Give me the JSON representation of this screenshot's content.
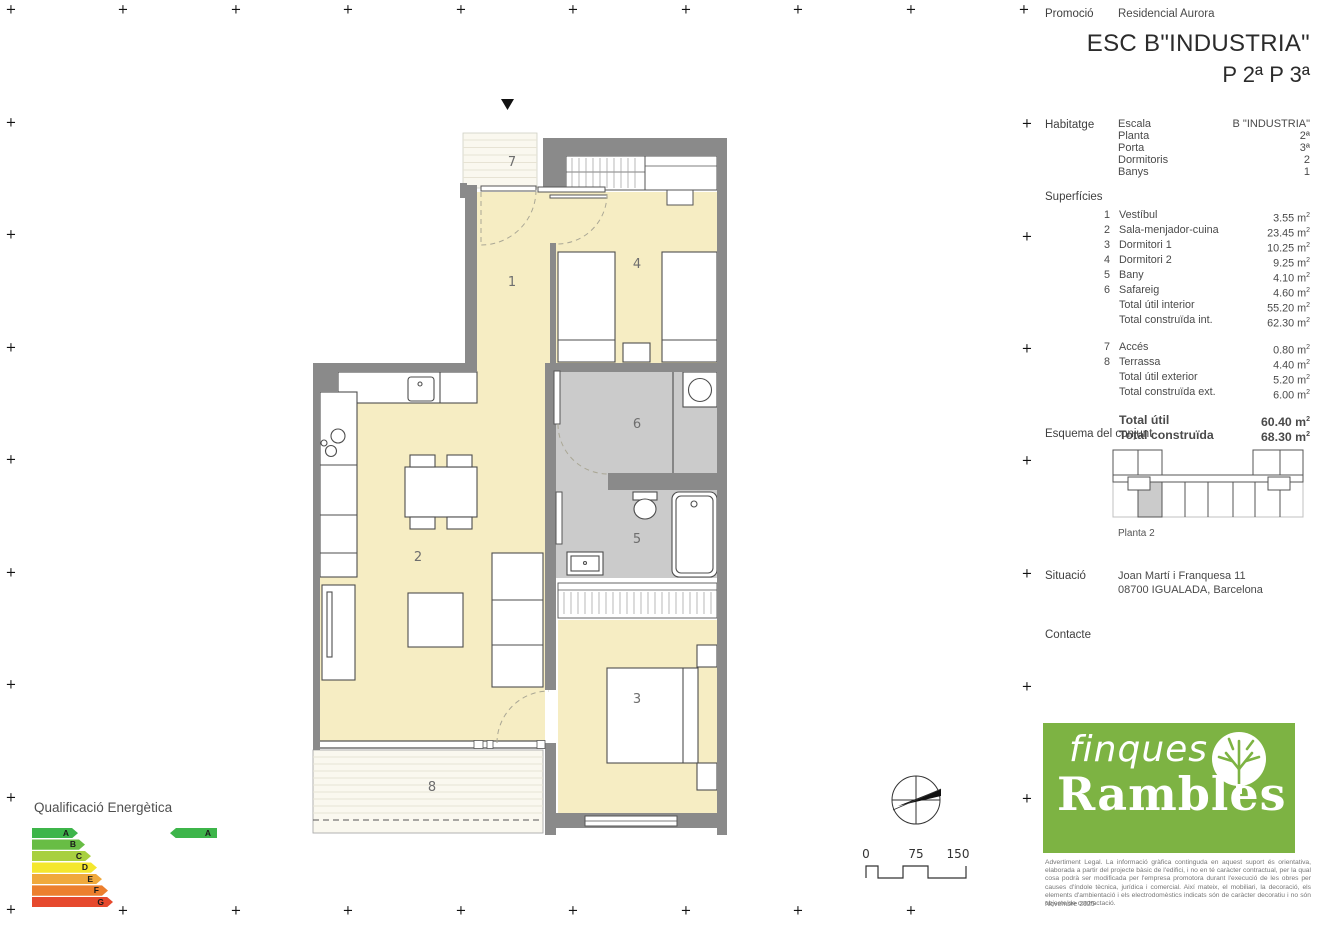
{
  "header": {
    "promo_label": "Promoció",
    "promo_value": "Residencial Aurora",
    "title": "ESC B\"INDUSTRIA\"",
    "subtitle": "P 2ª P 3ª"
  },
  "habitatge": {
    "label": "Habitatge",
    "rows": [
      {
        "k": "Escala",
        "v": "B \"INDUSTRIA\""
      },
      {
        "k": "Planta",
        "v": "2ª"
      },
      {
        "k": "Porta",
        "v": "3ª"
      },
      {
        "k": "Dormitoris",
        "v": "2"
      },
      {
        "k": "Banys",
        "v": "1"
      }
    ]
  },
  "surfaces": {
    "label": "Superfícies",
    "unit_base": "m",
    "unit_sup": "2",
    "group1": [
      {
        "num": "1",
        "name": "Vestíbul",
        "area": "3.55"
      },
      {
        "num": "2",
        "name": "Sala-menjador-cuina",
        "area": "23.45"
      },
      {
        "num": "3",
        "name": "Dormitori 1",
        "area": "10.25"
      },
      {
        "num": "4",
        "name": "Dormitori 2",
        "area": "9.25"
      },
      {
        "num": "5",
        "name": "Bany",
        "area": "4.10"
      },
      {
        "num": "6",
        "name": "Safareig",
        "area": "4.60"
      },
      {
        "num": "",
        "name": "Total útil interior",
        "area": "55.20"
      },
      {
        "num": "",
        "name": "Total construïda int.",
        "area": "62.30"
      }
    ],
    "group2": [
      {
        "num": "7",
        "name": "Accés",
        "area": "0.80"
      },
      {
        "num": "8",
        "name": "Terrassa",
        "area": "4.40"
      },
      {
        "num": "",
        "name": "Total útil exterior",
        "area": "5.20"
      },
      {
        "num": "",
        "name": "Total construïda ext.",
        "area": "6.00"
      }
    ],
    "totals": [
      {
        "num": "",
        "name": "Total útil",
        "area": "60.40"
      },
      {
        "num": "",
        "name": "Total construïda",
        "area": "68.30"
      }
    ]
  },
  "esquema": {
    "label": "Esquema del conjunt",
    "caption": "Planta 2"
  },
  "situacio": {
    "label": "Situació",
    "line1": "Joan Martí i Franquesa 11",
    "line2": "08700 IGUALADA, Barcelona"
  },
  "contacte": {
    "label": "Contacte"
  },
  "logo": {
    "line1": "finques",
    "line2": "Rambles"
  },
  "legal": {
    "text": "Advertiment Legal. La informació gràfica continguda en aquest suport és orientativa, elaborada a partir del projecte bàsic de l'edifici, i no en té caràcter contractual, per la qual cosa podrà ser modificada per l'empresa promotora durant l'execució de les obres per causes d'índole tècnica, jurídica i comercial. Així mateix, el mobiliari, la decoració, els elements d'ambientació i els electrodomèstics indicats són de caràcter decoratiu i no són objecte de contractació.",
    "date": "Novembre 2025"
  },
  "energy": {
    "title": "Qualificació Energètica",
    "levels": [
      {
        "letter": "A",
        "color": "#3db54a",
        "width": 46
      },
      {
        "letter": "B",
        "color": "#68bd45",
        "width": 53
      },
      {
        "letter": "C",
        "color": "#a8d040",
        "width": 59
      },
      {
        "letter": "D",
        "color": "#f4e72e",
        "width": 65
      },
      {
        "letter": "E",
        "color": "#f0a93c",
        "width": 70
      },
      {
        "letter": "F",
        "color": "#ec7f2e",
        "width": 76
      },
      {
        "letter": "G",
        "color": "#e6492d",
        "width": 81
      }
    ],
    "rating": {
      "letter": "A",
      "color": "#3db54a"
    }
  },
  "plan": {
    "rooms": [
      {
        "num": "1",
        "x": 512,
        "y": 286
      },
      {
        "num": "2",
        "x": 418,
        "y": 561
      },
      {
        "num": "3",
        "x": 637,
        "y": 703
      },
      {
        "num": "4",
        "x": 637,
        "y": 268
      },
      {
        "num": "5",
        "x": 637,
        "y": 543
      },
      {
        "num": "6",
        "x": 637,
        "y": 428
      },
      {
        "num": "7",
        "x": 512,
        "y": 166
      },
      {
        "num": "8",
        "x": 432,
        "y": 791
      }
    ]
  },
  "scalebar": {
    "labels": [
      "0",
      "75",
      "150"
    ]
  },
  "colors": {
    "wall": "#8a8a8a",
    "floor": "#f6edc3",
    "wet": "#cbcbcb",
    "cream": "#faf8ef",
    "stripe": "#e7e3d4",
    "brand": "#7db343",
    "ink": "#4a4a4a"
  },
  "reg_marks": {
    "top": {
      "y": 10,
      "xs": [
        11,
        123,
        236,
        348,
        461,
        573,
        686,
        798,
        911,
        1024
      ]
    },
    "left": {
      "x": 11,
      "ys": [
        123,
        235,
        348,
        460,
        573,
        685,
        798,
        910
      ]
    },
    "bottom": {
      "y": 911,
      "xs": [
        123,
        236,
        348,
        461,
        573,
        686,
        798,
        911
      ]
    },
    "right": {
      "x": 1027,
      "ys": [
        124,
        237,
        349,
        461,
        574,
        687,
        799
      ]
    }
  }
}
